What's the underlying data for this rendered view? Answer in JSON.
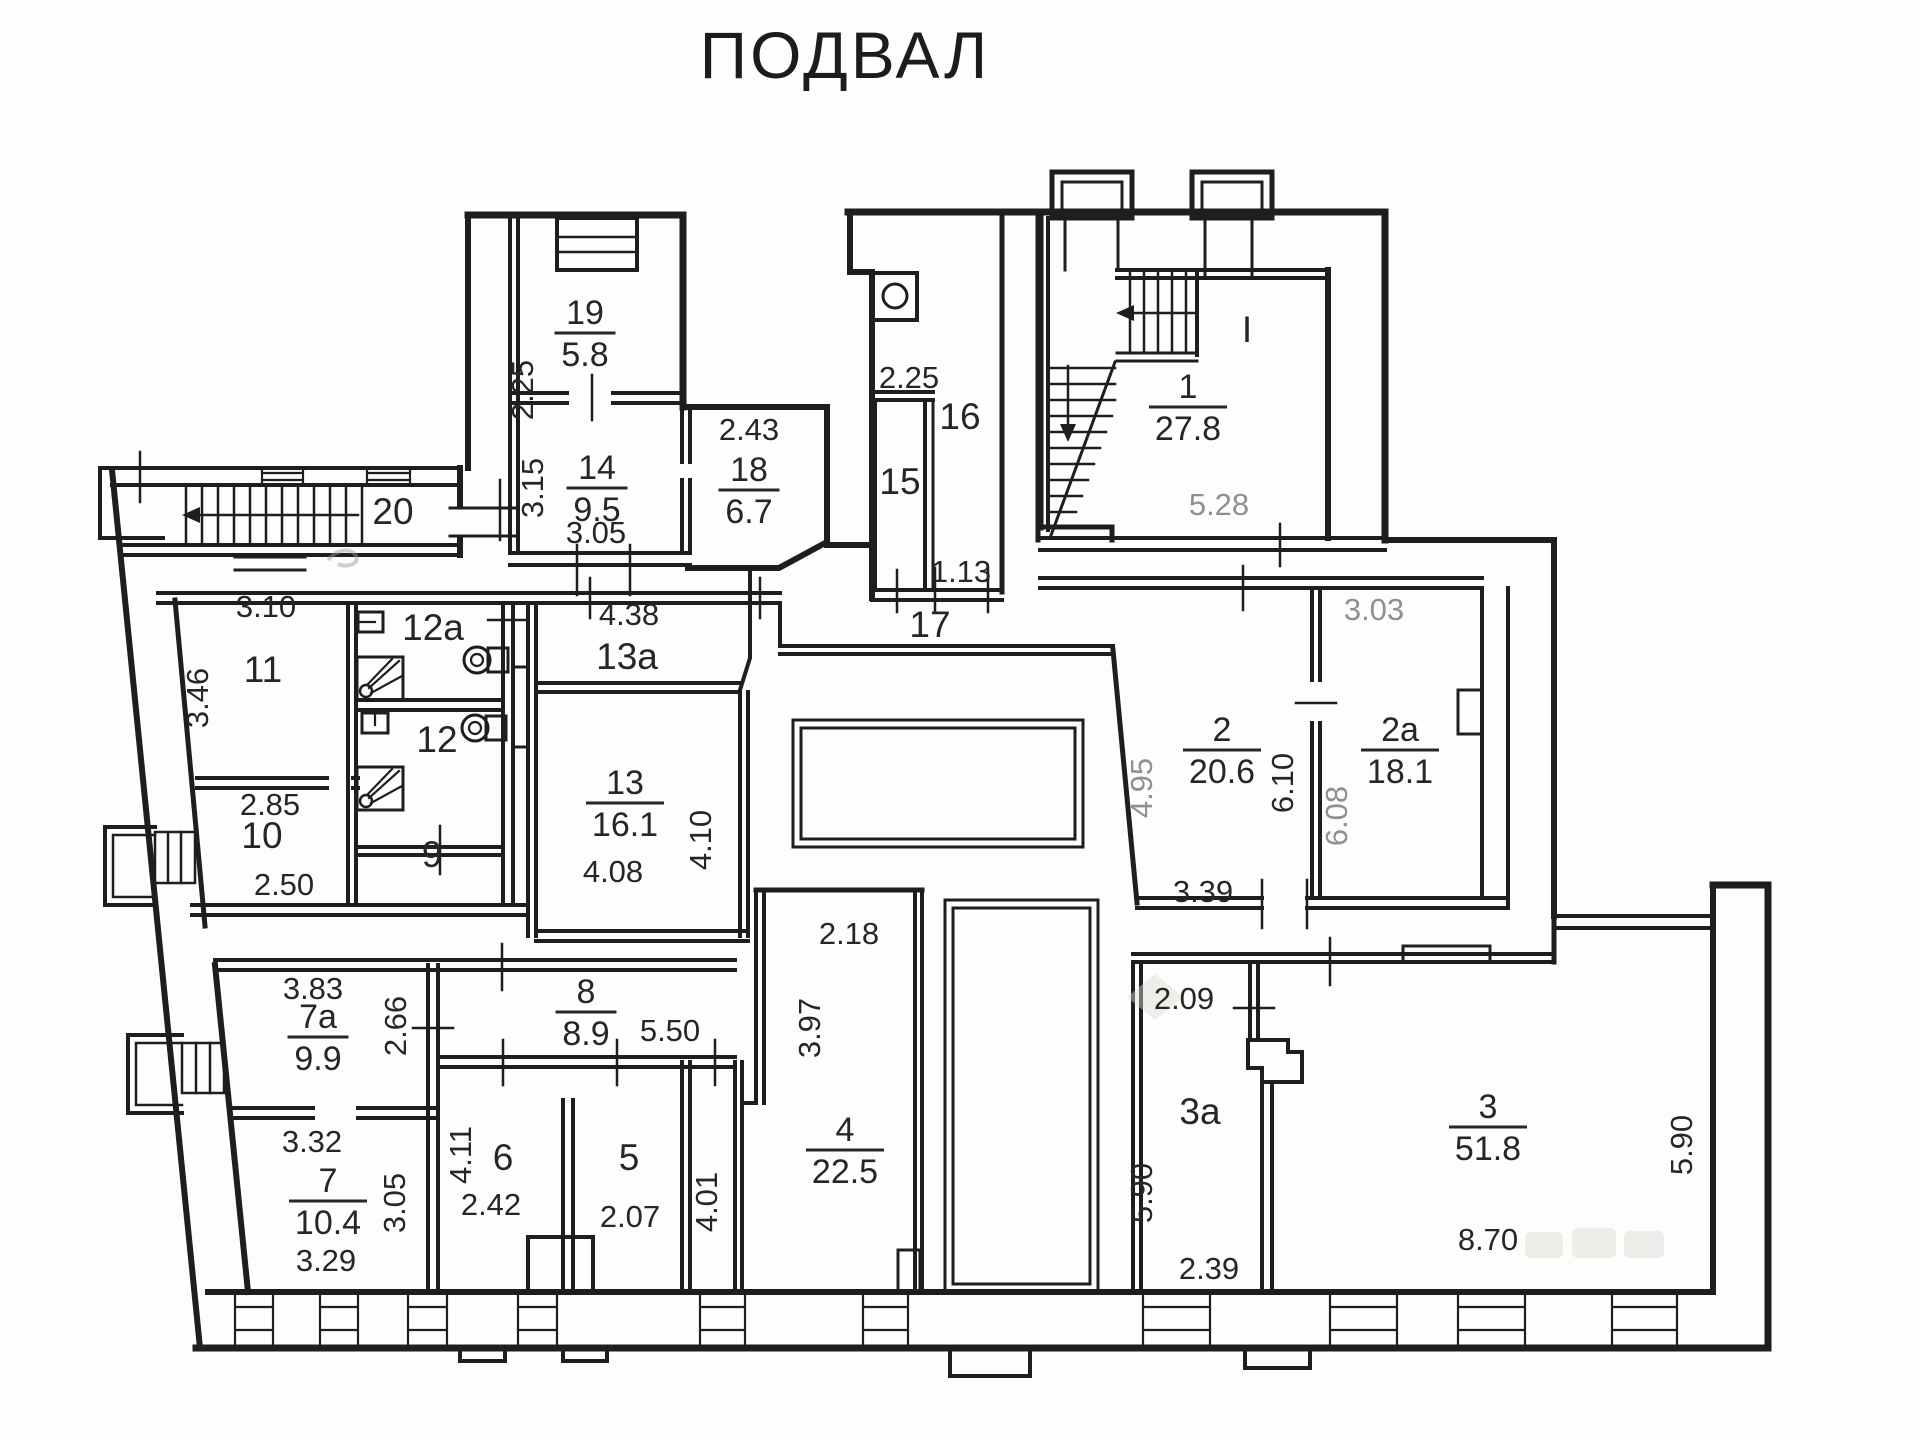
{
  "title": "ПОДВАЛ",
  "floor_plan": {
    "colors": {
      "ink": "#262626",
      "muted": "#8f8f8f",
      "walls": "#1e1e1e",
      "background": "#fdfdfc"
    },
    "rooms": [
      {
        "number": "19",
        "area": "5.8",
        "x": 585,
        "y": 333
      },
      {
        "number": "14",
        "area": "9.5",
        "x": 597,
        "y": 488
      },
      {
        "number": "18",
        "area": "6.7",
        "x": 749,
        "y": 490
      },
      {
        "number": "1",
        "area": "27.8",
        "x": 1188,
        "y": 407
      },
      {
        "number": "13",
        "area": "16.1",
        "x": 625,
        "y": 803
      },
      {
        "number": "2",
        "area": "20.6",
        "x": 1222,
        "y": 750
      },
      {
        "number": "2a",
        "area": "18.1",
        "x": 1400,
        "y": 750
      },
      {
        "number": "8",
        "area": "8.9",
        "x": 586,
        "y": 1012
      },
      {
        "number": "7a",
        "area": "9.9",
        "x": 318,
        "y": 1037
      },
      {
        "number": "7",
        "area": "10.4",
        "x": 328,
        "y": 1201
      },
      {
        "number": "4",
        "area": "22.5",
        "x": 845,
        "y": 1150
      },
      {
        "number": "3",
        "area": "51.8",
        "x": 1488,
        "y": 1127
      }
    ],
    "room_marks": [
      {
        "label": "20",
        "x": 393,
        "y": 524
      },
      {
        "label": "11",
        "x": 263,
        "y": 682
      },
      {
        "label": "10",
        "x": 262,
        "y": 848
      },
      {
        "label": "12a",
        "x": 433,
        "y": 640
      },
      {
        "label": "12",
        "x": 437,
        "y": 752
      },
      {
        "label": "9",
        "x": 432,
        "y": 867
      },
      {
        "label": "13a",
        "x": 627,
        "y": 669
      },
      {
        "label": "15",
        "x": 900,
        "y": 494
      },
      {
        "label": "16",
        "x": 960,
        "y": 429
      },
      {
        "label": "17",
        "x": 930,
        "y": 637
      },
      {
        "label": "6",
        "x": 503,
        "y": 1170
      },
      {
        "label": "5",
        "x": 629,
        "y": 1170
      },
      {
        "label": "3a",
        "x": 1200,
        "y": 1124
      },
      {
        "label": "I",
        "x": 1247,
        "y": 342
      }
    ],
    "dimensions": [
      {
        "value": "2.25",
        "x": 533,
        "y": 390,
        "vertical": true
      },
      {
        "value": "3.15",
        "x": 543,
        "y": 488,
        "vertical": true
      },
      {
        "value": "3.05",
        "x": 596,
        "y": 543
      },
      {
        "value": "2.43",
        "x": 749,
        "y": 440
      },
      {
        "value": "2.25",
        "x": 909,
        "y": 388
      },
      {
        "value": "1.13",
        "x": 961,
        "y": 582
      },
      {
        "value": "3.10",
        "x": 266,
        "y": 617
      },
      {
        "value": "3.46",
        "x": 208,
        "y": 698,
        "vertical": true
      },
      {
        "value": "2.85",
        "x": 270,
        "y": 815
      },
      {
        "value": "2.50",
        "x": 284,
        "y": 895
      },
      {
        "value": "4.38",
        "x": 629,
        "y": 625
      },
      {
        "value": "4.08",
        "x": 613,
        "y": 882
      },
      {
        "value": "4.10",
        "x": 711,
        "y": 840,
        "vertical": true
      },
      {
        "value": "5.28",
        "x": 1219,
        "y": 515,
        "muted": true
      },
      {
        "value": "3.03",
        "x": 1374,
        "y": 620,
        "muted": true
      },
      {
        "value": "4.95",
        "x": 1152,
        "y": 788,
        "vertical": true,
        "muted": true
      },
      {
        "value": "6.10",
        "x": 1293,
        "y": 783,
        "vertical": true
      },
      {
        "value": "6.08",
        "x": 1347,
        "y": 816,
        "vertical": true,
        "muted": true
      },
      {
        "value": "3.39",
        "x": 1203,
        "y": 902
      },
      {
        "value": "2.18",
        "x": 849,
        "y": 944
      },
      {
        "value": "3.97",
        "x": 820,
        "y": 1028,
        "vertical": true
      },
      {
        "value": "2.09",
        "x": 1184,
        "y": 1009
      },
      {
        "value": "5.90",
        "x": 1152,
        "y": 1193,
        "vertical": true
      },
      {
        "value": "2.39",
        "x": 1209,
        "y": 1279
      },
      {
        "value": "8.70",
        "x": 1488,
        "y": 1250
      },
      {
        "value": "5.90",
        "x": 1692,
        "y": 1145,
        "vertical": true
      },
      {
        "value": "3.83",
        "x": 313,
        "y": 999
      },
      {
        "value": "2.66",
        "x": 406,
        "y": 1026,
        "vertical": true
      },
      {
        "value": "3.32",
        "x": 312,
        "y": 1152
      },
      {
        "value": "3.29",
        "x": 326,
        "y": 1271
      },
      {
        "value": "3.05",
        "x": 405,
        "y": 1203,
        "vertical": true
      },
      {
        "value": "4.11",
        "x": 471,
        "y": 1155,
        "vertical": true
      },
      {
        "value": "2.42",
        "x": 491,
        "y": 1215
      },
      {
        "value": "2.07",
        "x": 630,
        "y": 1227
      },
      {
        "value": "5.50",
        "x": 670,
        "y": 1041
      },
      {
        "value": "4.01",
        "x": 717,
        "y": 1202,
        "vertical": true
      }
    ]
  }
}
